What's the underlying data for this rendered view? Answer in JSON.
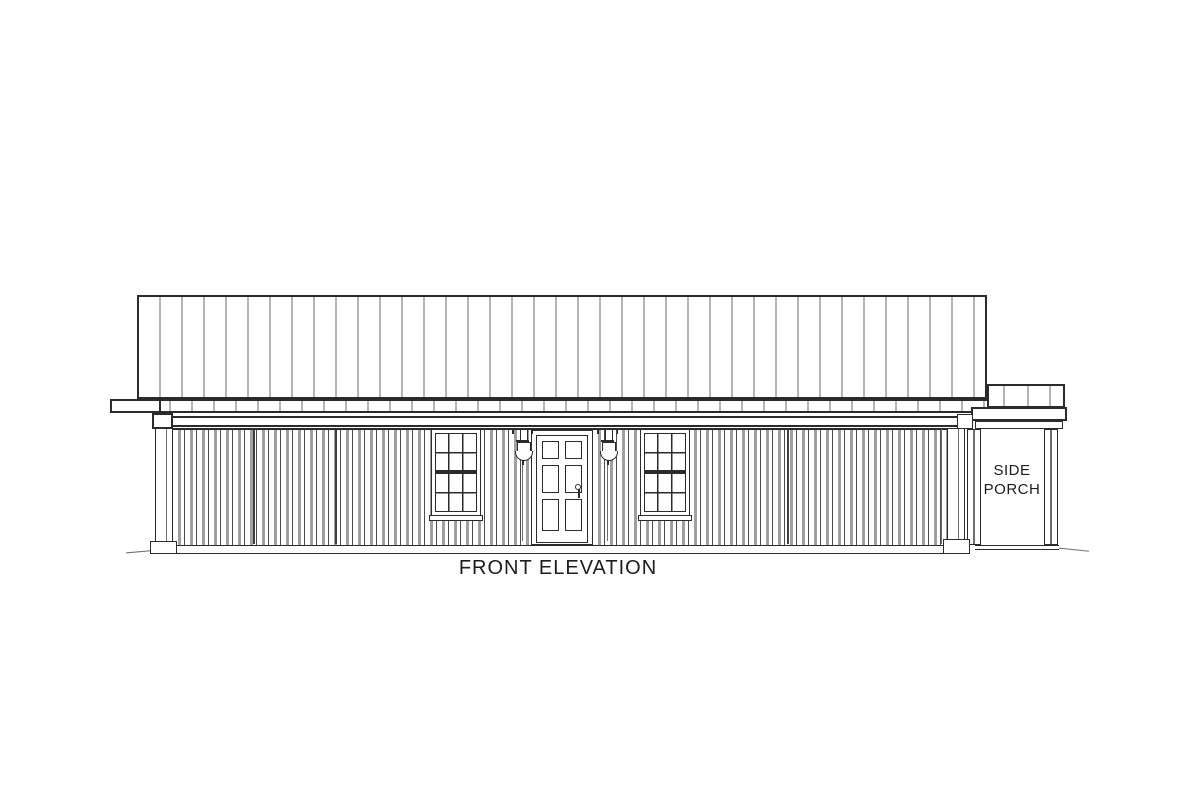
{
  "labels": {
    "drawing_title": "FRONT ELEVATION",
    "side_porch_line1": "SIDE",
    "side_porch_line2": "PORCH"
  },
  "colors": {
    "background": "#ffffff",
    "line": "#2b2b2b",
    "line_soft": "#6e6e6e",
    "rib": "#b4b4b4",
    "batten_dark": "#4c4c4c",
    "batten_gray": "#a0a0a0",
    "text": "#1c1c1c"
  },
  "roof": {
    "style": "standing-seam metal, vertical ribs",
    "rib_spacing_px": 22,
    "panel_joint_x": [
      363,
      652,
      697,
      742,
      923
    ]
  },
  "side_porch_roof": {
    "rib_x": [
      1003,
      1027,
      1049
    ]
  },
  "wall": {
    "siding_style": "vertical board-and-batten",
    "divider_x": [
      253,
      335,
      787
    ]
  },
  "windows": {
    "style": "double-hung, 6-over-6 grilles",
    "count": 2
  },
  "door": {
    "style": "six-panel entry door",
    "count": 1
  },
  "lighting": {
    "style": "wall lantern sconce",
    "count": 2
  }
}
